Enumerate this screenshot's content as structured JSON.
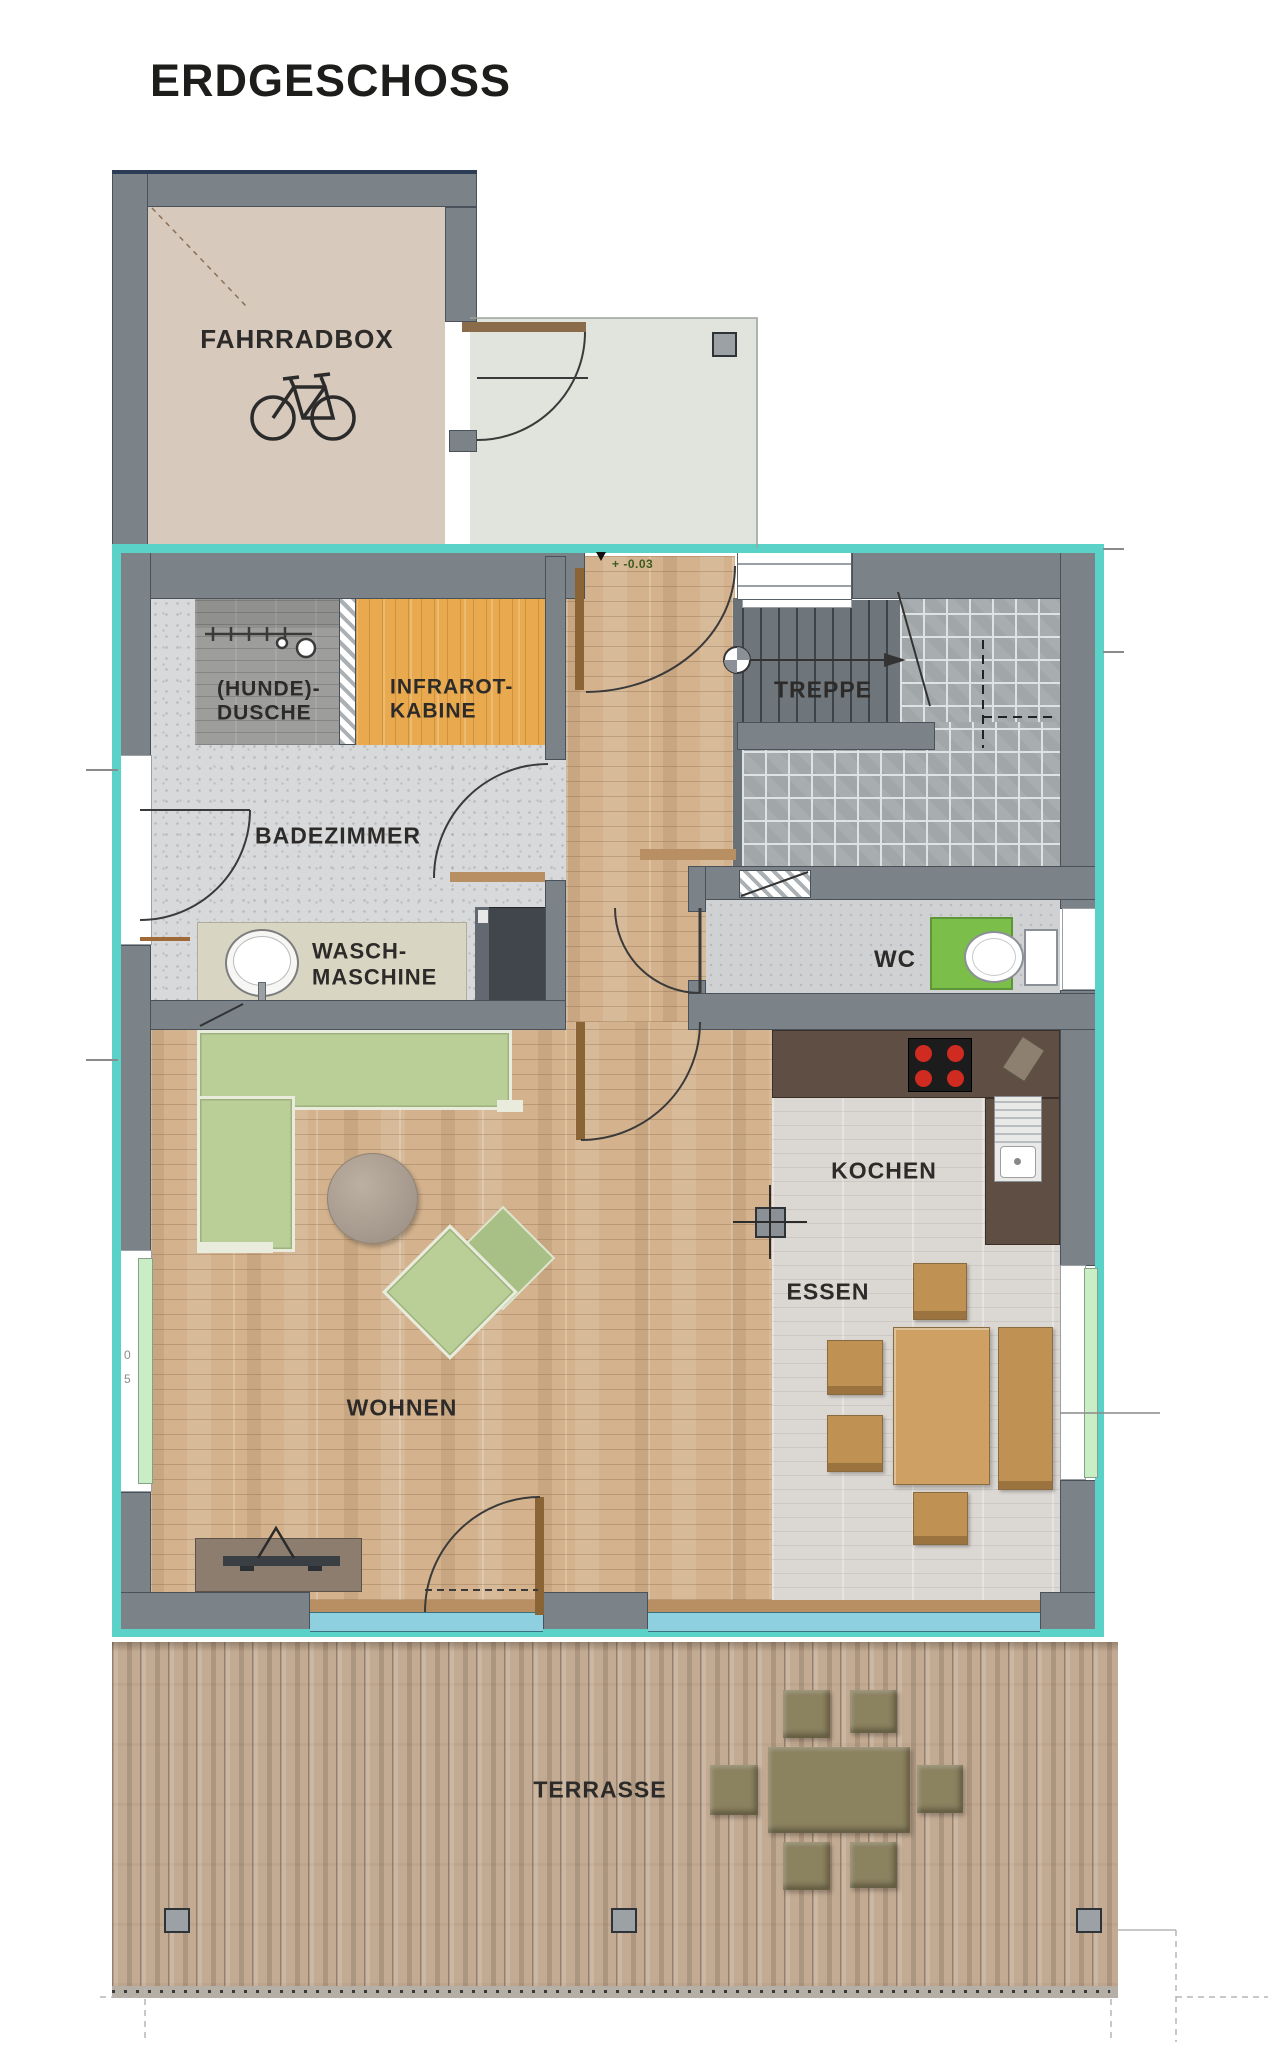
{
  "title": "ERDGESCHOSS",
  "rooms": {
    "fahrradbox": {
      "label": "FAHRRADBOX"
    },
    "dusche": {
      "line1": "(HUNDE)-",
      "line2": "DUSCHE"
    },
    "infrarot": {
      "line1": "INFRAROT-",
      "line2": "KABINE"
    },
    "treppe": {
      "label": "TREPPE"
    },
    "badezimmer": {
      "label": "BADEZIMMER"
    },
    "waschmaschine": {
      "line1": "WASCH-",
      "line2": "MASCHINE"
    },
    "wc": {
      "label": "WC"
    },
    "kochen": {
      "label": "KOCHEN"
    },
    "essen": {
      "label": "ESSEN"
    },
    "wohnen": {
      "label": "WOHNEN"
    },
    "terrasse": {
      "label": "TERRASSE"
    }
  },
  "annotations": {
    "floor_level": "+ -0.03",
    "dim_mark_top": "0",
    "dim_mark_bottom": "5"
  },
  "icons": {
    "bicycle": "bicycle-icon",
    "toilet": "toilet-icon",
    "washbasin": "washbasin-icon",
    "cooktop": "cooktop-icon",
    "sink": "sink-icon",
    "stair_walkline": "stair-walkline-icon",
    "tv_antenna": "tv-antenna-icon"
  },
  "colors": {
    "exterior_insulation_teal": "#5bd2c8",
    "wall_gray": "#7b8288",
    "fahrradbox_floor": "#d7c9bc",
    "parquet_wood": "#d3b28d",
    "infrarot_wood": "#e8a94f",
    "sofa_green": "#b9cf97",
    "wc_rug_green": "#7cbe4a",
    "burner_red": "#cf2b20",
    "kitchen_counter": "#5e4e44",
    "terrace_wood": "#c3ab93",
    "glazing_blue": "#8ed0e0",
    "glazing_green": "#c9eec6"
  }
}
